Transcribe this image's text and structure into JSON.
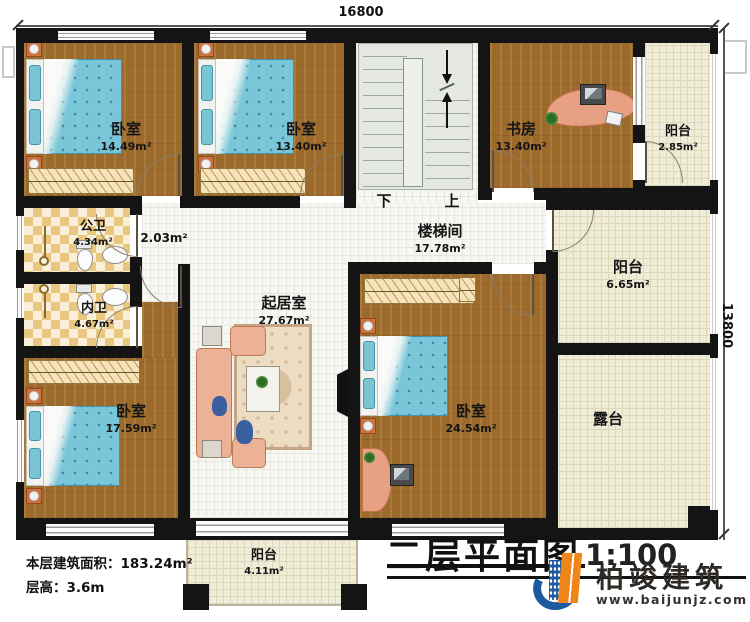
{
  "dimensions": {
    "top": "16800",
    "right": "13800"
  },
  "rooms": {
    "bedroom_tl": {
      "name": "卧室",
      "area": "14.49m²"
    },
    "bedroom_tm": {
      "name": "卧室",
      "area": "13.40m²"
    },
    "study": {
      "name": "书房",
      "area": "13.40m²"
    },
    "balcony_tr": {
      "name": "阳台",
      "area": "2.85m²"
    },
    "stairwell": {
      "name": "楼梯间",
      "area": "17.78m²"
    },
    "balcony_r": {
      "name": "阳台",
      "area": "6.65m²"
    },
    "terrace": {
      "name": "露台"
    },
    "bath_public": {
      "name": "公卫",
      "area": "4.34m²"
    },
    "bath_private": {
      "name": "内卫",
      "area": "4.67m²"
    },
    "corridor": {
      "area": "2.03m²"
    },
    "living": {
      "name": "起居室",
      "area": "27.67m²"
    },
    "bedroom_bl": {
      "name": "卧室",
      "area": "17.59m²"
    },
    "bedroom_br": {
      "name": "卧室",
      "area": "24.54m²"
    },
    "balcony_b": {
      "name": "阳台",
      "area": "4.11m²"
    }
  },
  "stairs": {
    "down": "下",
    "up": "上"
  },
  "title": {
    "text": "二层平面图",
    "scale": "1:100"
  },
  "footer": {
    "area_label": "本层建筑面积：",
    "area_value": "183.24m²",
    "height_label": "层高：",
    "height_value": "3.6m"
  },
  "logo": {
    "company": "柏竣建筑",
    "website": "www.baijunjz.com"
  },
  "colors": {
    "wall": "#141414",
    "wood_floor": "#9c6a2a",
    "tile": "#eac77e",
    "mattress": "#79c6d8",
    "sofa": "#edb296",
    "logo_blue": "#1e5aa0",
    "logo_orange": "#f08519"
  }
}
